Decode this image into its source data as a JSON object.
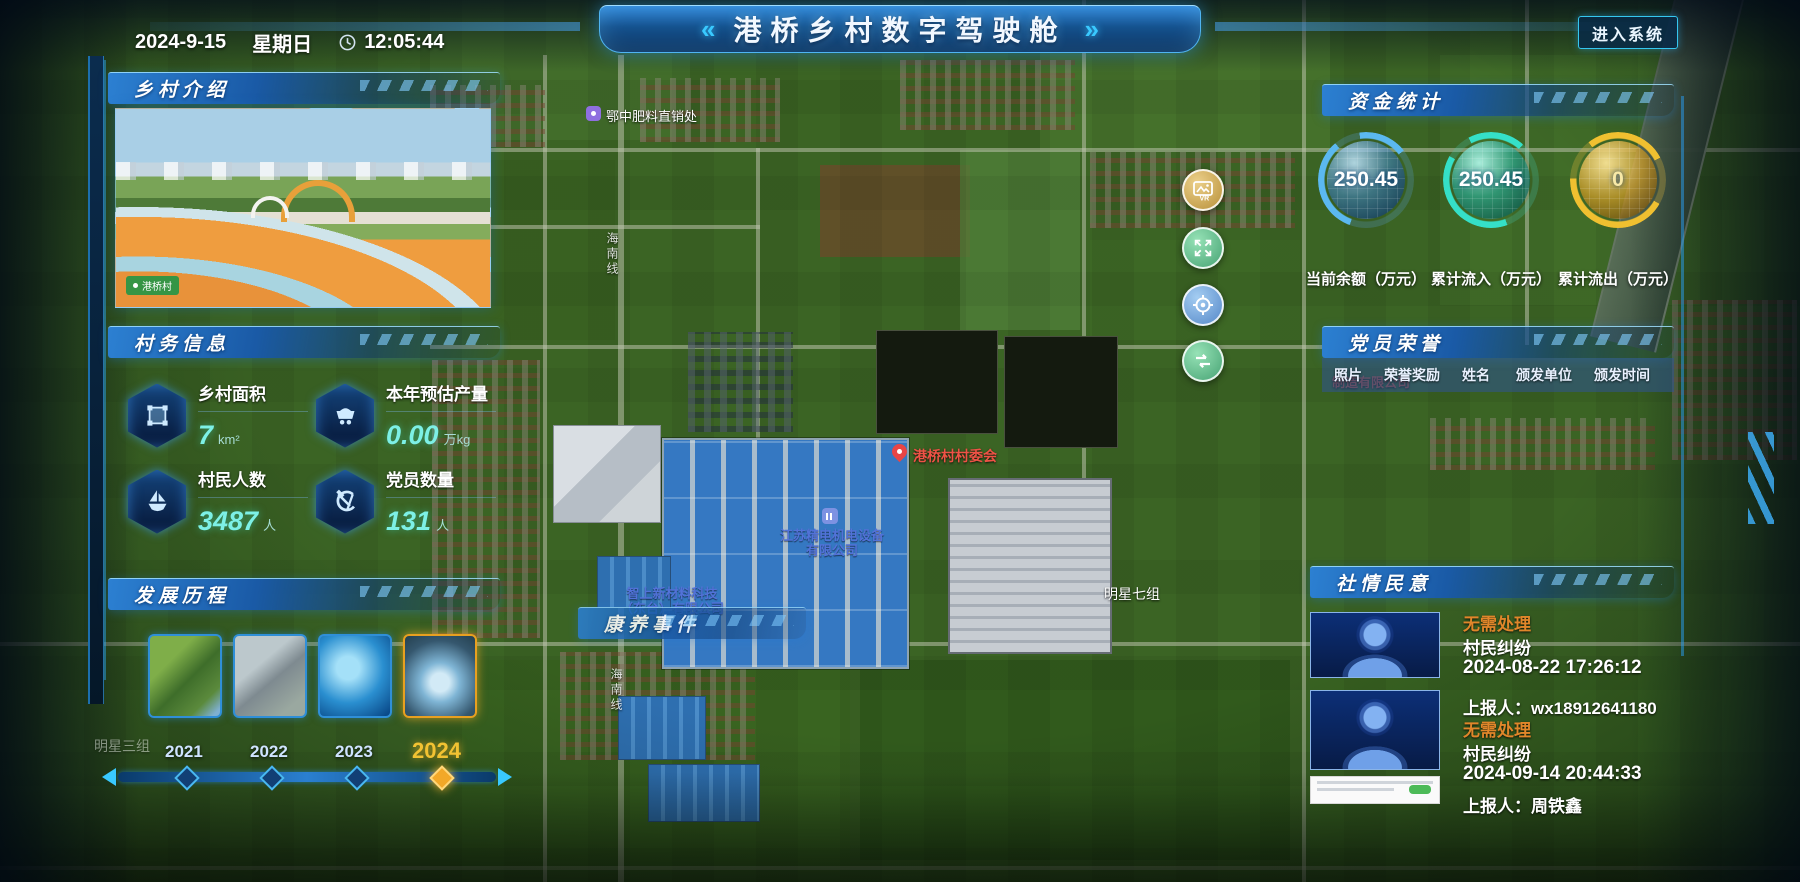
{
  "header": {
    "date": "2024-9-15",
    "weekday": "星期日",
    "time": "12:05:44",
    "title": "港桥乡村数字驾驶舱",
    "chevron_left": "«",
    "chevron_right": "»",
    "enter_button": "进入系统"
  },
  "intro": {
    "title": "乡村介绍",
    "photo_tag": "港桥村"
  },
  "affairs": {
    "title": "村务信息",
    "stats": [
      {
        "icon": "area-icon",
        "label": "乡村面积",
        "value": "7",
        "unit": "km²"
      },
      {
        "icon": "cart-icon",
        "label": "本年预估产量",
        "value": "0.00",
        "unit": "万kg"
      },
      {
        "icon": "boat-icon",
        "label": "村民人数",
        "value": "3487",
        "unit": "人"
      },
      {
        "icon": "party-icon",
        "label": "党员数量",
        "value": "131",
        "unit": "人"
      }
    ]
  },
  "history": {
    "title": "发展历程",
    "years": [
      "2021",
      "2022",
      "2023",
      "2024"
    ],
    "active_year": "2024"
  },
  "funds": {
    "title": "资金统计",
    "gauges": [
      {
        "value": "250.45",
        "label": "当前余额（万元）",
        "color": "#5bb8f0"
      },
      {
        "value": "250.45",
        "label": "累计流入（万元）",
        "color": "#35e0c8"
      },
      {
        "value": "0",
        "label": "累计流出（万元）",
        "color": "#f0c030"
      }
    ]
  },
  "honors": {
    "title": "党员荣誉",
    "columns": [
      "照片",
      "荣誉奖励",
      "姓名",
      "颁发单位",
      "颁发时间"
    ]
  },
  "sentiment": {
    "title": "社情民意",
    "status_color": "#e0862a",
    "items": [
      {
        "status": "无需处理",
        "type": "村民纠纷",
        "time": "2024-08-22 17:26:12",
        "reporter": "上报人：wx18912641180"
      },
      {
        "status": "无需处理",
        "type": "村民纠纷",
        "time": "2024-09-14 20:44:33",
        "reporter": "上报人：周铁鑫"
      }
    ]
  },
  "map": {
    "event_panel_title": "康养事件",
    "labels": {
      "fertilizer": "鄂中肥料直销处",
      "committee": "港桥村村委会",
      "company1_line1": "江苏精电机电设备",
      "company1_line2": "有限公司",
      "company2_line1": "智上新材料科技",
      "company2_line2": "（东台）有限公司",
      "group7": "明星七组",
      "group3": "明星三组",
      "company3": "制造有限公司",
      "road": "海南线"
    },
    "controls": [
      {
        "icon": "vr-image-icon",
        "label": "VR"
      },
      {
        "icon": "expand-icon"
      },
      {
        "icon": "locate-icon"
      },
      {
        "icon": "switch-icon"
      }
    ]
  },
  "colors": {
    "accent_cyan": "#35c7f0",
    "panel_header_blue": "#1e6fc4",
    "active_year_orange": "#f2a828"
  }
}
